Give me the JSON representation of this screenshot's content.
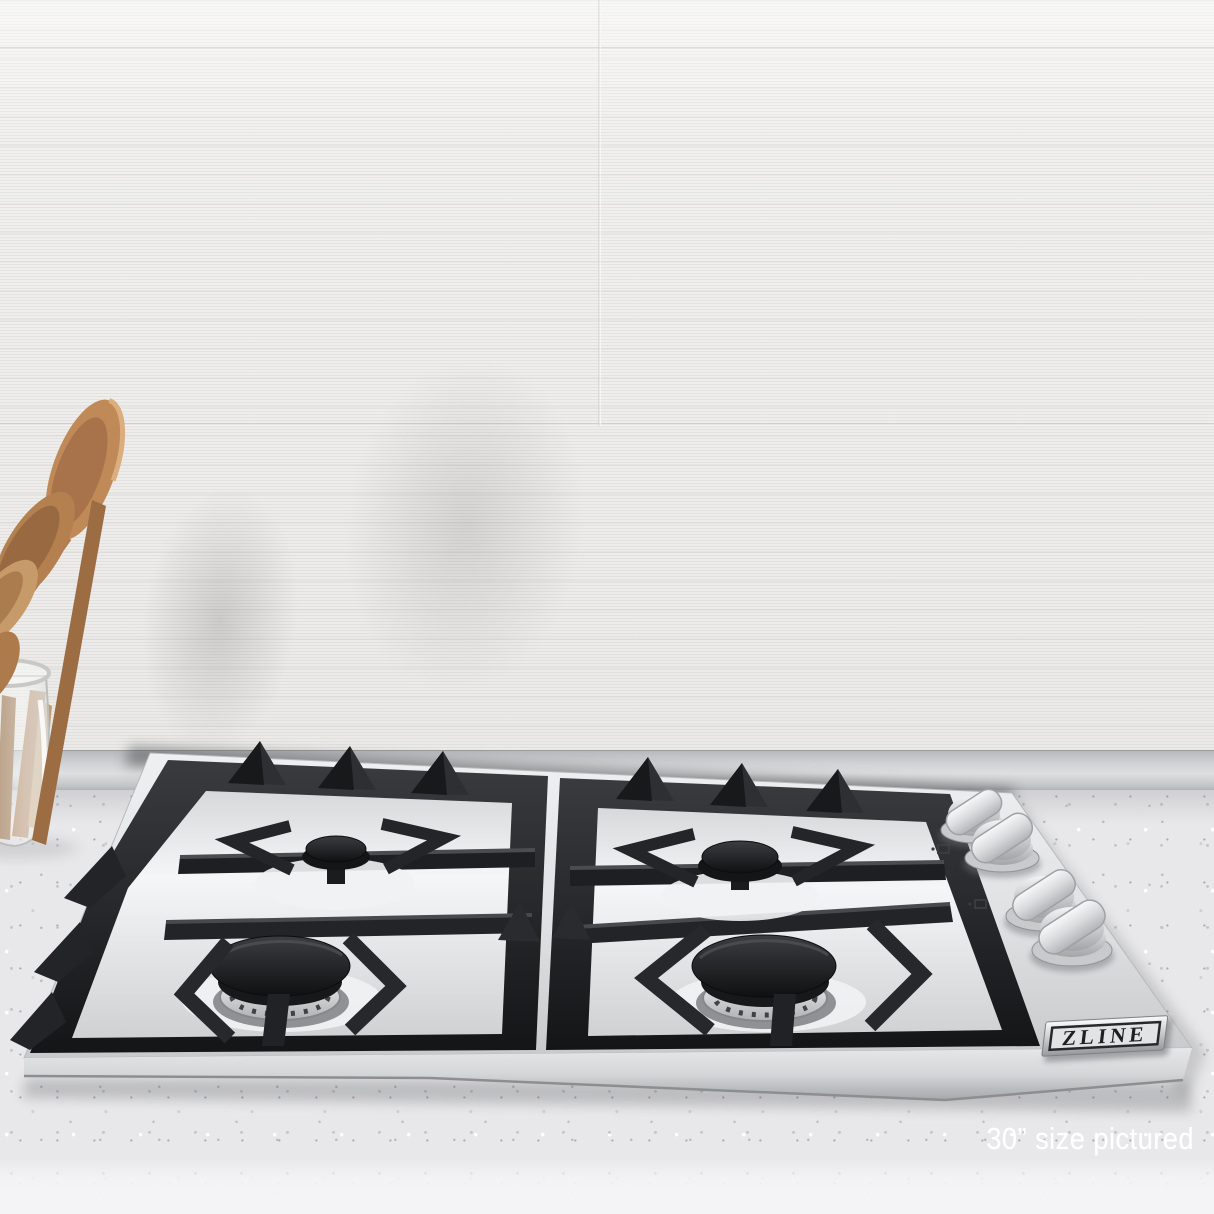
{
  "scene": {
    "description": "Stainless steel 4-burner gas cooktop with black cast-iron grates installed in a white speckled countertop, white striated tile backsplash behind, wooden spoons in a glass jar at left",
    "caption": "30” size pictured",
    "badge_text": "ZLINE",
    "burner_count": 4,
    "knob_count": 4
  },
  "palette": {
    "wall": "#f1f0ee",
    "trim": "#c6c8ca",
    "counter": "#e8e8ea",
    "counter-edge": "#f4f4f6",
    "steel": "#dfe1e3",
    "grate": "#232427",
    "burner-cap": "#17181b",
    "wood": "#bb8a5a",
    "caption-text": "#ffffff"
  }
}
